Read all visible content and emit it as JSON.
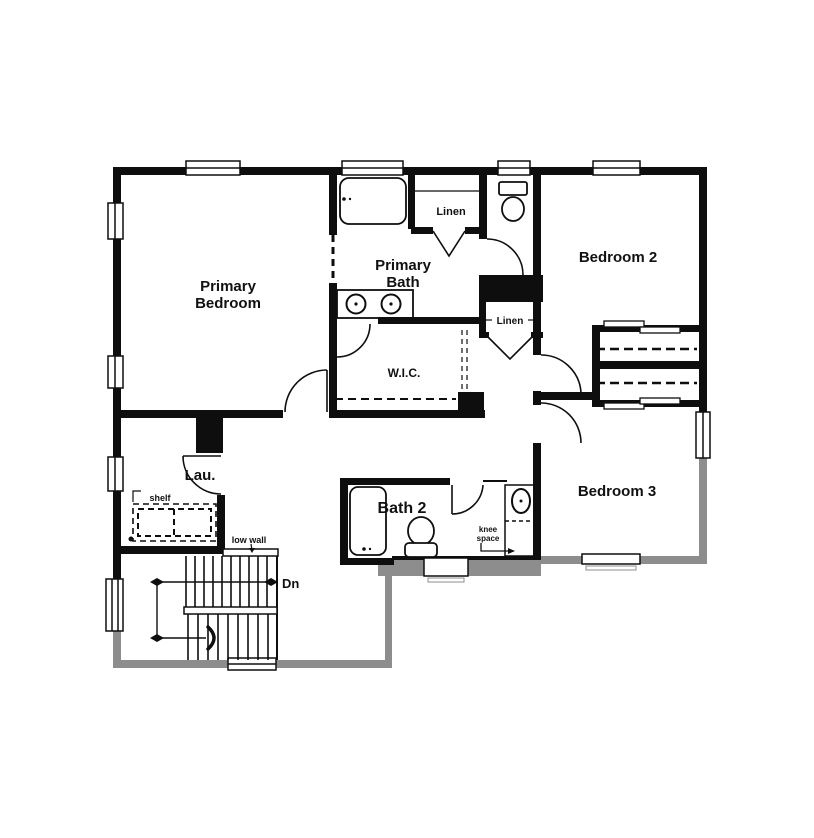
{
  "title": "Second floor plan",
  "colors": {
    "wall": "#0e0e0e",
    "below_floor": "#8d8d8d",
    "background": "#ffffff"
  },
  "rooms": {
    "primary_bedroom": {
      "line1": "Primary",
      "line2": "Bedroom"
    },
    "primary_bath": {
      "line1": "Primary",
      "line2": "Bath"
    },
    "bedroom2": {
      "label": "Bedroom 2"
    },
    "bedroom3": {
      "label": "Bedroom 3"
    },
    "wic": {
      "label": "W.I.C."
    },
    "laundry": {
      "label": "Lau."
    },
    "bath2": {
      "label": "Bath 2"
    },
    "linen_top": {
      "label": "Linen"
    },
    "linen_mid": {
      "label": "Linen"
    }
  },
  "annotations": {
    "shelf": "shelf",
    "low_wall": "low wall",
    "knee_space": {
      "line1": "knee",
      "line2": "space"
    },
    "down": "Dn"
  }
}
